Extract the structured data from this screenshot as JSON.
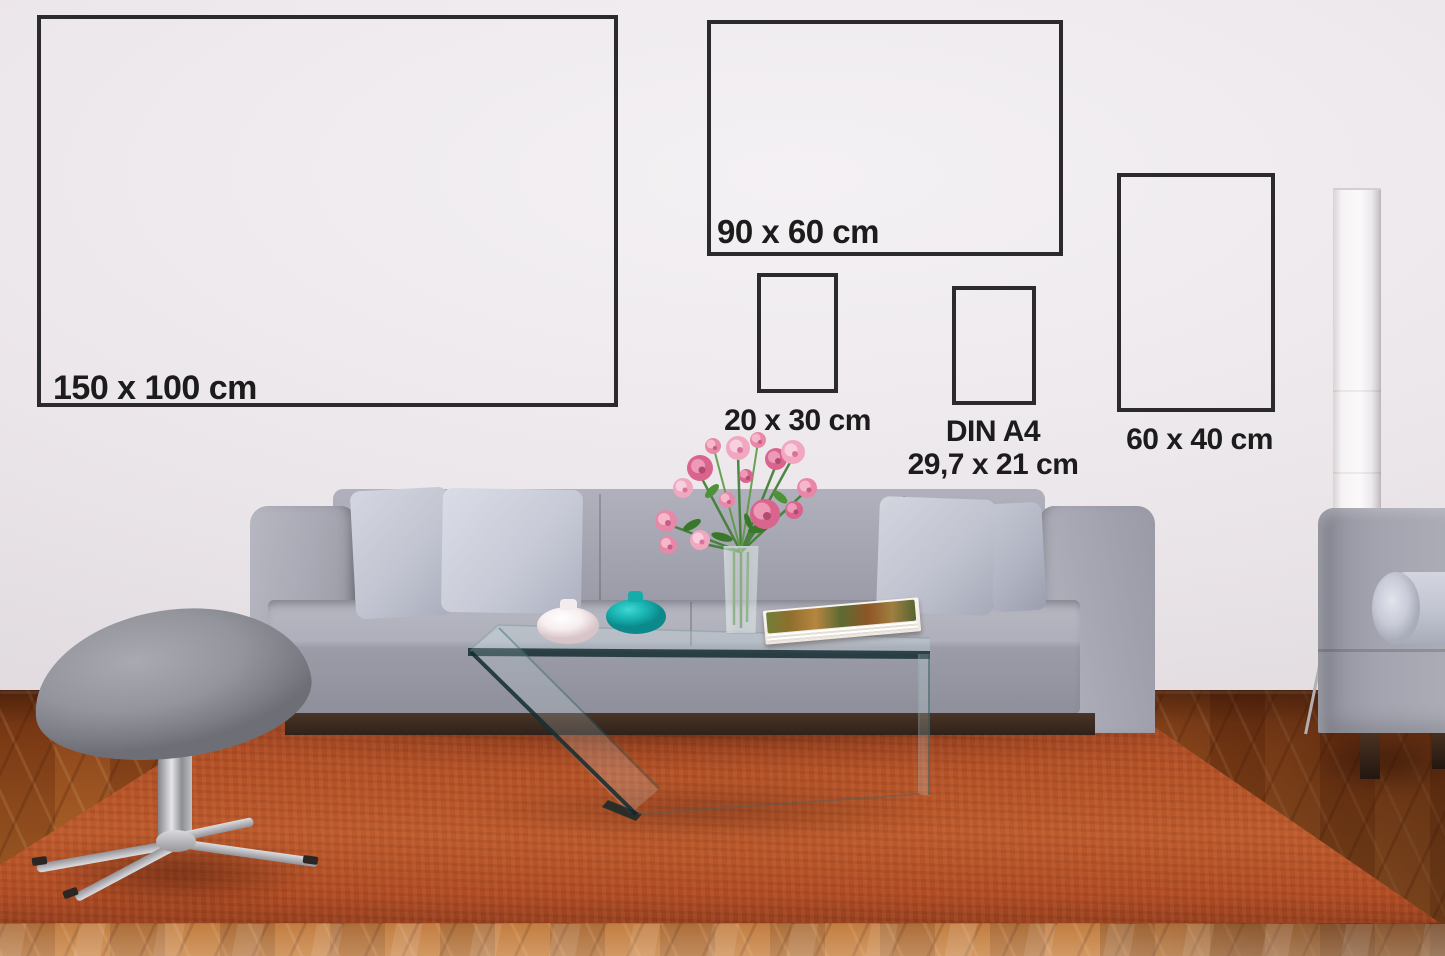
{
  "frames": [
    {
      "label": "150 x 100 cm"
    },
    {
      "label": "90 x 60 cm"
    },
    {
      "label": "20 x 30 cm"
    },
    {
      "label": "DIN A4",
      "sublabel": "29,7 x 21 cm"
    },
    {
      "label": "60 x 40 cm"
    }
  ],
  "palette": {
    "frame_border": "#2b2b2b",
    "label_text": "#1c1c1c",
    "wall": "#eae5e9",
    "rug": "#b35127",
    "wood_floor": "#9c5522",
    "sofa_fabric": "#a2a3ae",
    "pillow": "#cfd2dc",
    "teal_vase": "#18b3b1",
    "white_vase": "#f7eff1",
    "flower_pink": "#e2799f",
    "chrome": "#c7c7cb",
    "book_pages": "#f5f1ea"
  }
}
